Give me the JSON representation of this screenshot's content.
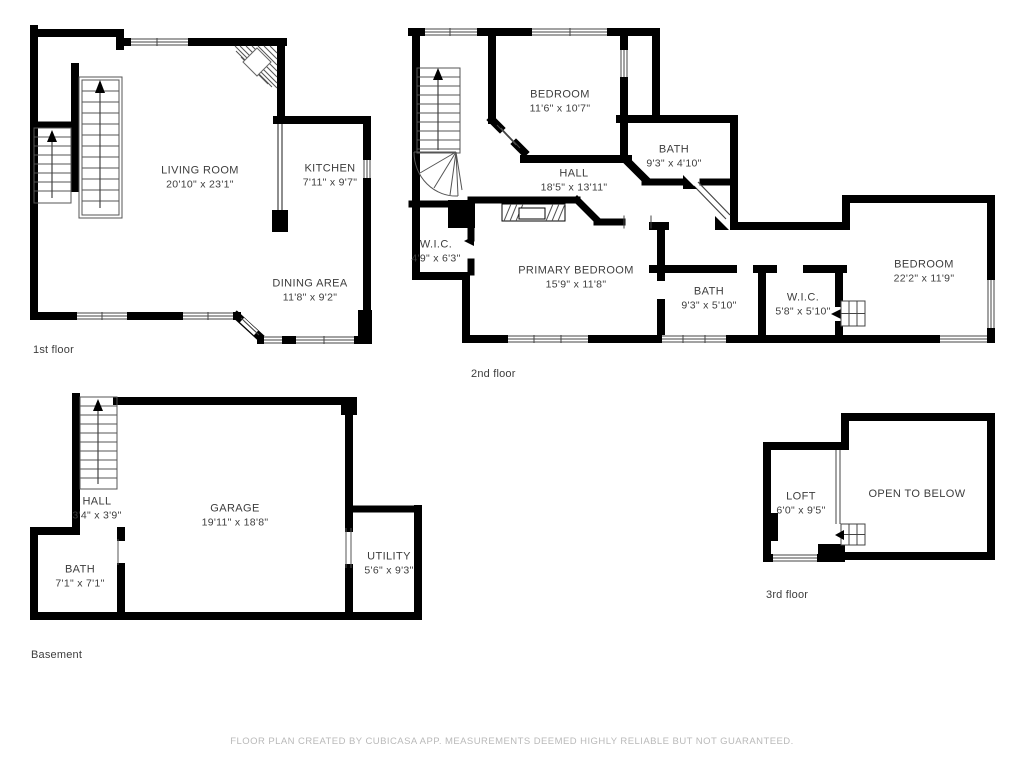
{
  "app": {
    "footer": "FLOOR PLAN CREATED BY CUBICASA APP. MEASUREMENTS DEEMED HIGHLY RELIABLE BUT NOT GUARANTEED."
  },
  "colors": {
    "wall": "#000000",
    "room_text": "#3d3d3d",
    "footer_text": "#b9b9b9",
    "background": "#ffffff"
  },
  "floors": [
    {
      "caption": "1st floor",
      "rooms": [
        {
          "name": "LIVING ROOM",
          "dims": "20'10\" x 23'1\""
        },
        {
          "name": "KITCHEN",
          "dims": "7'11\" x 9'7\""
        },
        {
          "name": "DINING AREA",
          "dims": "11'8\" x 9'2\""
        }
      ]
    },
    {
      "caption": "2nd floor",
      "rooms": [
        {
          "name": "BEDROOM",
          "dims": "11'6\" x 10'7\""
        },
        {
          "name": "BATH",
          "dims": "9'3\" x 4'10\""
        },
        {
          "name": "HALL",
          "dims": "18'5\" x 13'11\""
        },
        {
          "name": "W.I.C.",
          "dims": "4'9\" x 6'3\""
        },
        {
          "name": "PRIMARY BEDROOM",
          "dims": "15'9\" x 11'8\""
        },
        {
          "name": "BATH",
          "dims": "9'3\" x 5'10\""
        },
        {
          "name": "W.I.C.",
          "dims": "5'8\" x 5'10\""
        },
        {
          "name": "BEDROOM",
          "dims": "22'2\" x 11'9\""
        }
      ]
    },
    {
      "caption": "Basement",
      "rooms": [
        {
          "name": "HALL",
          "dims": "3'4\" x 3'9\""
        },
        {
          "name": "GARAGE",
          "dims": "19'11\" x 18'8\""
        },
        {
          "name": "BATH",
          "dims": "7'1\" x 7'1\""
        },
        {
          "name": "UTILITY",
          "dims": "5'6\" x 9'3\""
        }
      ]
    },
    {
      "caption": "3rd floor",
      "rooms": [
        {
          "name": "LOFT",
          "dims": "6'0\" x 9'5\""
        },
        {
          "name": "OPEN TO BELOW",
          "dims": ""
        }
      ]
    }
  ]
}
